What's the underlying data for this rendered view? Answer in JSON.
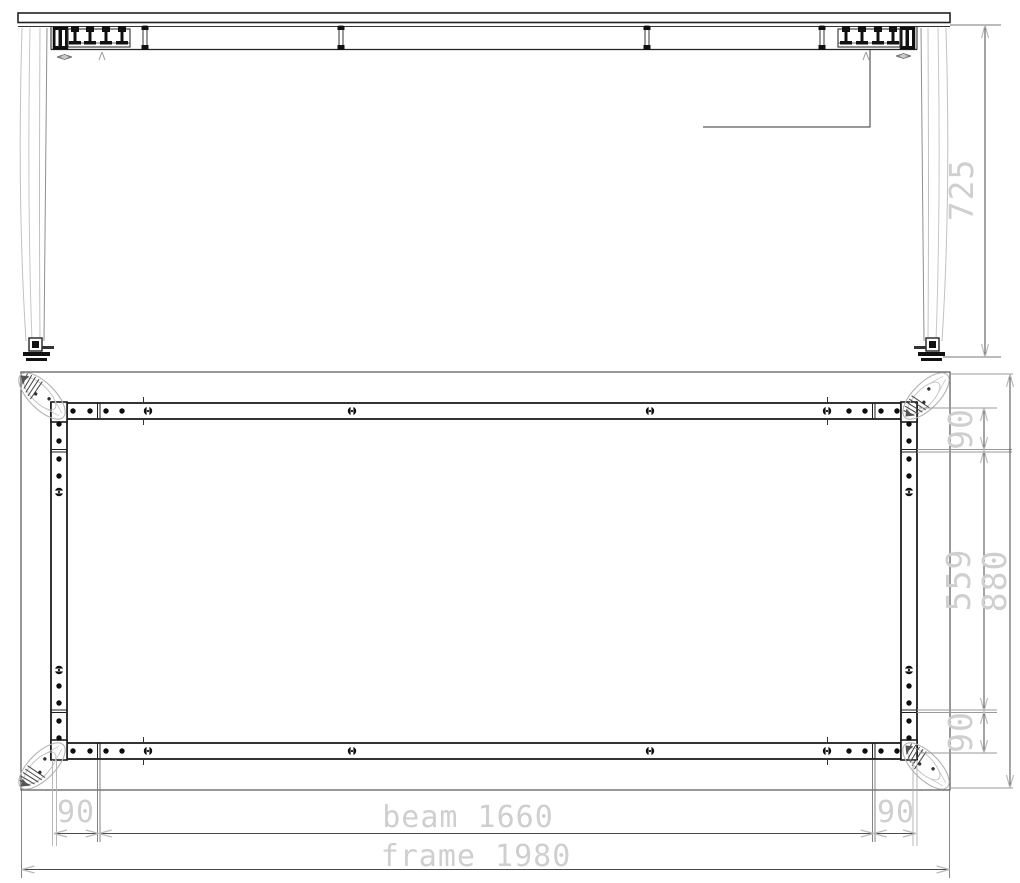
{
  "dims": {
    "height": "725",
    "side_top_offset": "90",
    "side_inner": "559",
    "side_overall": "880",
    "side_bottom_offset": "90",
    "bottom_left_offset": "90",
    "beam": "beam 1660",
    "bottom_right_offset": "90",
    "frame": "frame 1980"
  },
  "colors": {
    "line_dark": "#1d1d1d",
    "line_medium": "#4a4a4a",
    "line_light": "#9a9a9a",
    "leg_light": "#c2c2c2",
    "dim_text": "#cfcfcf",
    "arrow": "#b9b9b9"
  }
}
